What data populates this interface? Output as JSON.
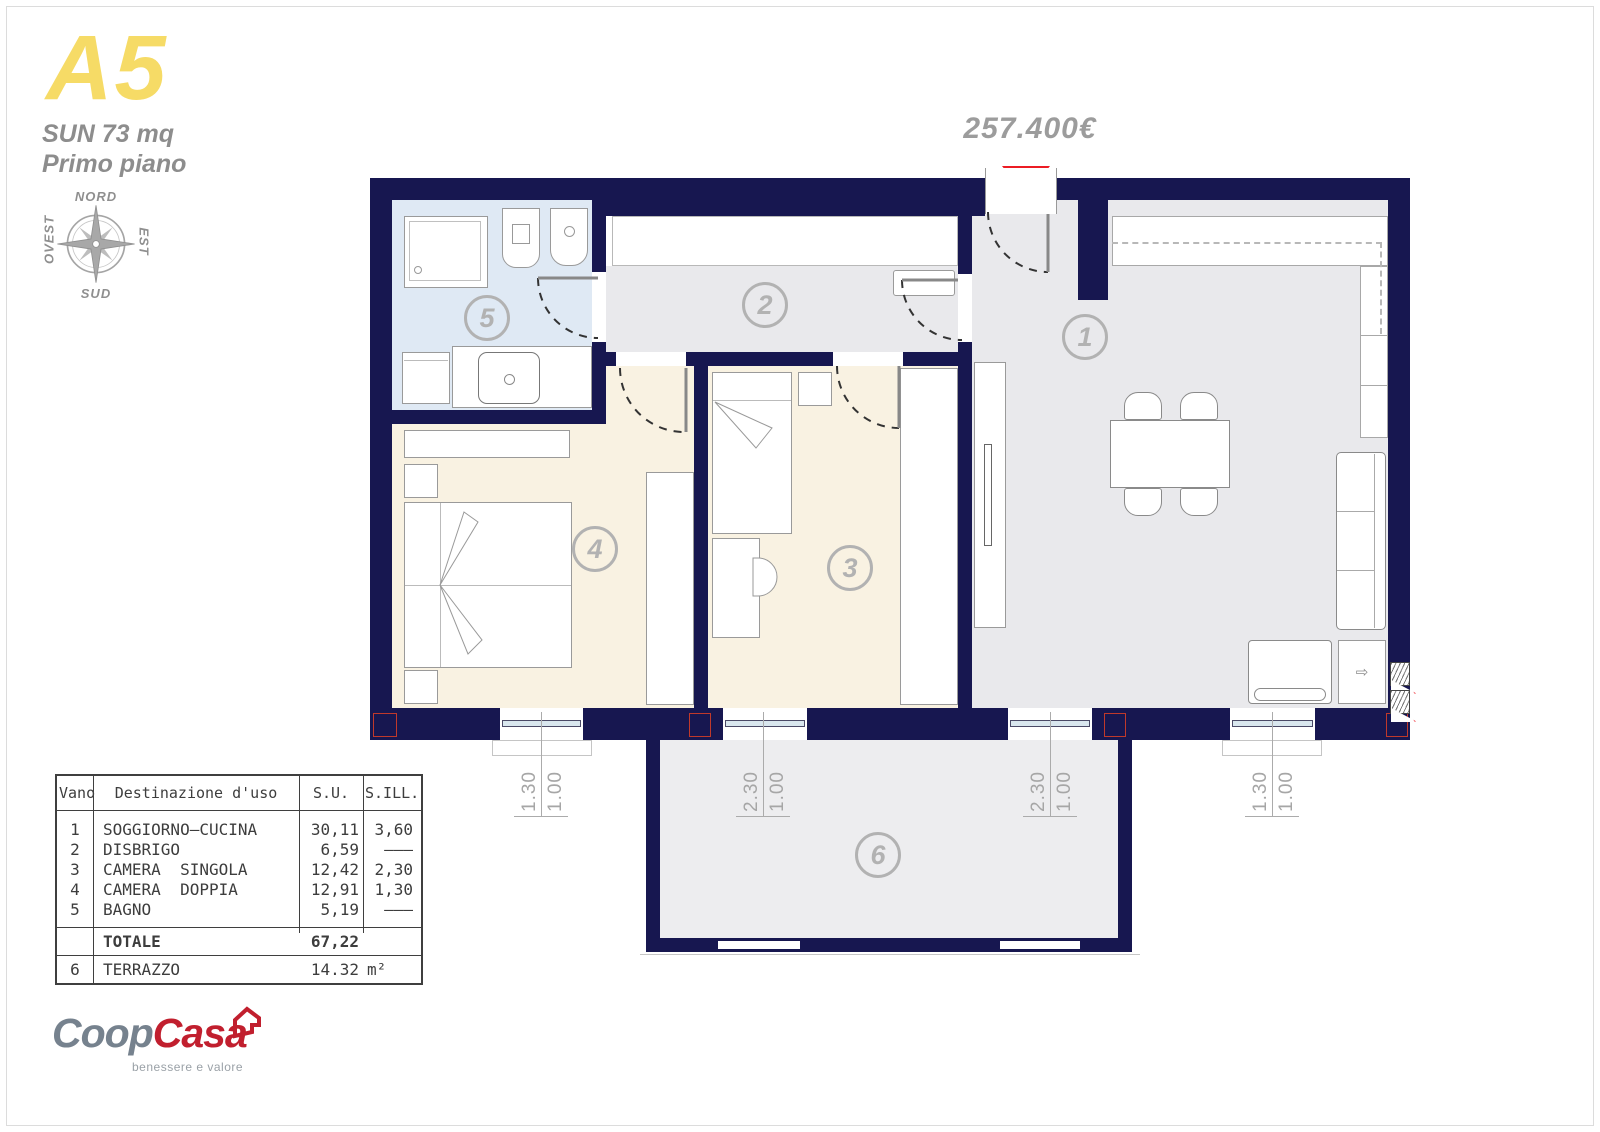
{
  "header": {
    "unit": "A5",
    "area": "SUN 73 mq",
    "floor": "Primo piano"
  },
  "compass": {
    "north": "NORD",
    "east": "EST",
    "south": "SUD",
    "west": "OVEST"
  },
  "price": "257.400€",
  "plan": {
    "rooms": [
      {
        "number": "1",
        "name": "soggiorno-cucina"
      },
      {
        "number": "2",
        "name": "disbrigo"
      },
      {
        "number": "3",
        "name": "camera singola"
      },
      {
        "number": "4",
        "name": "camera doppia"
      },
      {
        "number": "5",
        "name": "bagno"
      },
      {
        "number": "6",
        "name": "terrazzo"
      }
    ],
    "windows": [
      {
        "w": "1.00",
        "h": "1.30"
      },
      {
        "w": "1.00",
        "h": "2.30"
      },
      {
        "w": "1.00",
        "h": "2.30"
      },
      {
        "w": "1.00",
        "h": "1.30"
      }
    ]
  },
  "table": {
    "headers": {
      "vano": "Vano",
      "dest": "Destinazione d'uso",
      "su": "S.U.",
      "sill": "S.ILL."
    },
    "rows": [
      {
        "vano": "1",
        "dest": "SOGGIORNO—CUCINA",
        "su": "30,11",
        "sill": "3,60"
      },
      {
        "vano": "2",
        "dest": "DISBRIGO",
        "su": "6,59",
        "sill": "———"
      },
      {
        "vano": "3",
        "dest": "CAMERA  SINGOLA",
        "su": "12,42",
        "sill": "2,30"
      },
      {
        "vano": "4",
        "dest": "CAMERA  DOPPIA",
        "su": "12,91",
        "sill": "1,30"
      },
      {
        "vano": "5",
        "dest": "BAGNO",
        "su": "5,19",
        "sill": "———"
      }
    ],
    "total": {
      "label": "TOTALE",
      "su": "67,22"
    },
    "terrace": {
      "vano": "6",
      "dest": "TERRAZZO",
      "su": "14.32",
      "unit": "m²"
    }
  },
  "logo": {
    "coop": "Coop",
    "casa": "Casa",
    "tagline": "benessere e valore"
  },
  "colors": {
    "wall_navy": "#171750",
    "floor_gray": "#e9e9ec",
    "floor_beige": "#f9f2e2",
    "floor_bath": "#dfe9f4",
    "accent_red": "#ec1c24",
    "unit_yellow": "#f6db66"
  }
}
